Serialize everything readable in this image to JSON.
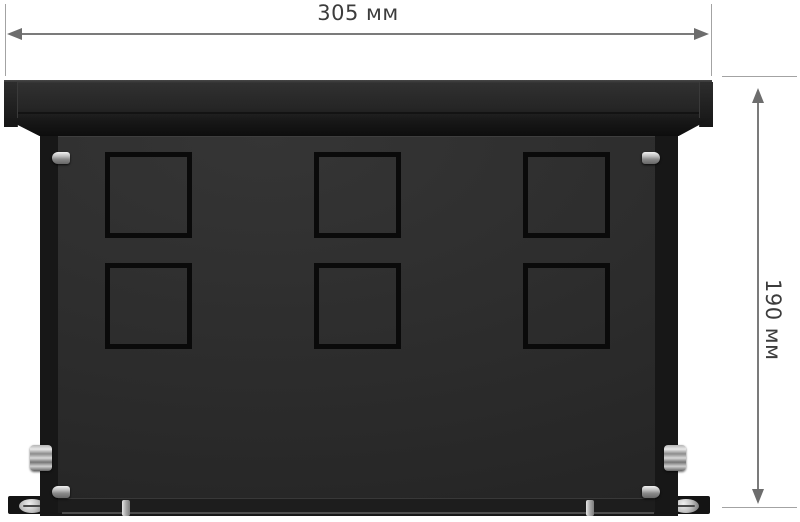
{
  "page": {
    "type": "product-dimension-diagram",
    "background": "#ffffff"
  },
  "dimensions": {
    "width": {
      "label": "305 мм",
      "value_mm": 305,
      "orientation": "horizontal"
    },
    "height": {
      "label": "190 мм",
      "value_mm": 190,
      "orientation": "vertical"
    }
  },
  "product": {
    "description": "black metal mounting box, front view",
    "knockout_grid": {
      "rows": 2,
      "columns": 3,
      "pattern": "square knockout with centre gaps"
    },
    "hardware": {
      "side_screws": 4,
      "cable_glands": 2,
      "mounting_feet": 2,
      "foot_screws": 2,
      "bottom_pins": 2
    },
    "colors": {
      "lid": "#2a2a2a",
      "front_panel": "#2c2c2c",
      "side_wall": "#171717",
      "knockout_slot": "#0a0a0a",
      "metal_hardware": "#c9c9c9",
      "dimension_line": "#7b7b7b",
      "dimension_text": "#3c3c3c"
    }
  }
}
